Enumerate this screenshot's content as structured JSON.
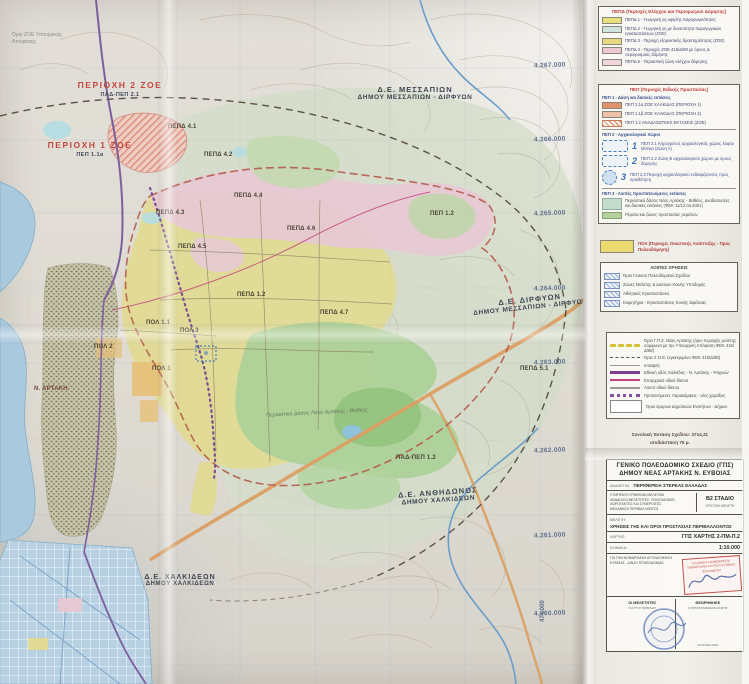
{
  "colors": {
    "zone_yellow": "#e0da94",
    "zone_pink": "#e7c9d5",
    "forest_green": "#abd098",
    "sea_blue": "#a9c9de",
    "road_orange": "#dc9e62",
    "boundary_red": "#b45b4b",
    "legend_title_red": "#c03a36",
    "stamp_red": "#c4524a",
    "stamp_blue": "#3a56a0"
  },
  "corner_note": {
    "line1": "Όριο ΖΟΕ Υπουργικής",
    "line2": "Απόφασης"
  },
  "map": {
    "region_labels": {
      "messapion": {
        "l1": "Δ.Ε. ΜΕΣΣΑΠΙΩΝ",
        "l2": "ΔΗΜΟΥ ΜΕΣΣΑΠΙΩΝ - ΔΙΡΦΥΩΝ"
      },
      "dirfyon": {
        "l1": "Δ.Ε. ΔΙΡΦΥΩΝ",
        "l2": "ΔΗΜΟΥ ΜΕΣΣΑΠΙΩΝ - ΔΙΡΦΥΩΝ"
      },
      "anthidonos": {
        "l1": "Δ.Ε. ΑΝΘΗΔΩΝΟΣ",
        "l2": "ΔΗΜΟΥ ΧΑΛΚΙΔΕΩΝ"
      },
      "chalkideon": {
        "l1": "Δ.Ε. ΧΑΛΚΙΔΕΩΝ",
        "l2": "ΔΗΜΟΥ ΧΑΛΚΙΔΕΩΝ"
      }
    },
    "red_labels": {
      "r1": "ΠΕΡΙΟΧΗ 2 ΖΟΕ",
      "r1sub": "ΠΑΔ-ΠΕΠ 2.1",
      "r2": "ΠΕΡΙΟΧΗ 1 ΖΟΕ",
      "r2sub": "ΠΕΠ 1.1α"
    },
    "zone_labels": [
      "ΠΕΠΔ 4.1",
      "ΠΕΠΔ 4.2",
      "ΠΕΠΔ 4.3",
      "ΠΕΠΔ 4.4",
      "ΠΕΠΔ 4.5",
      "ΠΕΠΔ 1.2",
      "ΠΕΠΔ 4.6",
      "ΠΕΠ 1.2",
      "ΠΟΛ 1.1",
      "ΠΟΛ 2",
      "ΠΟΛ 1",
      "ΠΟΛ 3",
      "Ν. ΑΡΤΑΚΗ",
      "ΠΑΔ-ΠΕΠ 1.2",
      "ΠΕΠΔ 4.7",
      "ΠΕΠΔ 5.1"
    ],
    "forest_label": "Περιαστικό Δάσος Νέας Αρτάκης - Βαθέος",
    "grid_labels": [
      "4.267.000",
      "4.266.000",
      "4.265.000",
      "4.264.000",
      "4.263.000",
      "4.262.000",
      "4.261.000",
      "4.260.000"
    ],
    "easting_label": "474.000"
  },
  "legend": {
    "pepd_panel": {
      "title": "ΠΕΠΔ (Περιοχές Ελέγχου και Περιορισμού Δόμησης)",
      "items": [
        {
          "label": "ΠΕΠΔ 1 - Γεωργική γη υψηλής παραγωγικότητας"
        },
        {
          "label": "ΠΕΠΔ 2 - Γεωργική γη με δυνατότητα παραγωγικών εγκαταστάσεων (ΖΟΕ)"
        },
        {
          "label": "ΠΕΠΔ 3 - Περιοχή εξορυκτικής δραστηριότητας (ΖΟΕ)"
        },
        {
          "label": "ΠΕΠΔ 4 - Περιοχές ΖΟΕ 416/Δ/88 με όρους & περιορισμούς δόμησης"
        },
        {
          "label": "ΠΕΠΔ 5 - Περιαστική ζώνη ελέγχου δόμησης"
        }
      ]
    },
    "pep_panel": {
      "title": "ΠΕΠ (Περιοχές Ειδικής Προστασίας)",
      "sub1": "ΠΕΠ 1 - Δάση και δασικές εκτάσεις",
      "items1": [
        {
          "label": "ΠΕΠ 1.1α ΖΟΕ ΧΑΛΚΙΔΑΣ (ΠΕΡΙΟΧΗ 1)"
        },
        {
          "label": "ΠΕΠ 1.1β ΖΟΕ ΧΑΛΚΙΔΑΣ (ΠΕΡΙΟΧΗ 2)"
        },
        {
          "label": "ΠΕΠ 1.2 ΑΝΑΔΑΣΩΤΕΕΣ ΕΚΤΑΣΕΙΣ (ΖΟΕ)"
        }
      ],
      "sub2": "ΠΕΠ 2 - Αρχαιολογικοί Χώροι",
      "items2": [
        {
          "num": "1",
          "label": "ΠΕΠ 2.1 Κηρυγμένος αρχαιολογικός χώρος λόφου Μύτικα (Ζώνη Α)"
        },
        {
          "num": "2",
          "label": "ΠΕΠ 2.2 Ζώνη Β αρχαιολογικού χώρου με όρους δόμησης"
        },
        {
          "num": "3",
          "label": "ΠΕΠ 2.3 Περιοχή αρχαιολογικού ενδιαφέροντος προς οριοθέτηση"
        }
      ],
      "sub3": "ΠΕΠ 3 - Λοιπές προστατευόμενες εκτάσεις",
      "items3": [
        {
          "label": "Περιαστικό δάσος Νέας Αρτάκης - Βαθέος, αναδασωτέες και δασικές εκτάσεις (ΦΕΚ 11/12.04.2001)"
        },
        {
          "label": "Ρέματα και ζώνες προστασίας ρεμάτων"
        }
      ]
    },
    "pol_row": {
      "label": "ΠΟΛ (Περιοχές Οικιστικής Ανάπτυξης - Προς Πολεοδόμηση)"
    },
    "other_panel": {
      "title": "ΛΟΙΠΕΣ ΧΡΗΣΕΙΣ",
      "items": [
        {
          "label": "Όρια Γενικού Πολεοδομικού Σχεδίου"
        },
        {
          "label": "Ζώνες Μελέτης & Δικτύων Κοινής Υποδομής"
        },
        {
          "label": "Αθλητικές Εγκαταστάσεις"
        },
        {
          "label": "Κοιμητήρια - Εγκαταστάσεις Κοινής Ωφέλειας"
        }
      ]
    },
    "lines_panel": {
      "items": [
        {
          "label": "Όριο Γ.Π.Σ. Νέας Αρτάκης (όριο περιοχής μελέτης σύμφωνα με την Υπουργική Απόφαση ΦΕΚ 416/Δ/88)"
        },
        {
          "label": "Όριο Ζ.Ο.Ε. (εγκεκριμένο ΦΕΚ 416/Δ/88)"
        },
        {
          "label": "Ισοϋψείς"
        },
        {
          "label": "Εθνική οδός Χαλκίδας - Ν. Αρτάκης - Ψαχνών"
        },
        {
          "label": "Επαρχιακό οδικό δίκτυο"
        },
        {
          "label": "Λοιπό οδικό δίκτυο"
        },
        {
          "label": "Προτεινόμενες παρακάμψεις - νέες χαράξεις"
        },
        {
          "label": "Όρια όμορων Δημοτικών Ενοτήτων - Δήμων"
        }
      ],
      "footer1": "Συνολική Έκταση Σχεδίου:  3714,31",
      "footer2": "ισοδιάσταση 75 μ."
    }
  },
  "titleblock": {
    "title1": "ΓΕΝΙΚΟ ΠΟΛΕΟΔΟΜΙΚΟ ΣΧΕΔΙΟ (ΓΠΣ)",
    "title2": "ΔΗΜΟΥ ΝΕΑΣ ΑΡΤΑΚΗΣ Ν. ΕΥΒΟΙΑΣ",
    "client_label": "ΑΝΑΘΕΤΗΣ:",
    "client": "ΠΕΡΙΦΕΡΕΙΑ ΣΤΕΡΕΑΣ ΕΛΛΑΔΑΣ",
    "consultant_lines": [
      "ΣΥΜΠΡΑΞΗ ΓΡΑΦΕΙΩΝ ΜΕΛΕΤΩΝ",
      "ΑΝΑΔΟΧΟΙ ΜΕΛΕΤΗΤΕΣ: ΠΟΛΕΟΔΟΜΟΙ,",
      "ΧΩΡΟΤΑΚΤΕΣ ΚΑΙ ΣΥΝΕΡΓΑΤΕΣ",
      "ΜΗΧΑΝΙΚΟΙ ΠΕΡΙΒΑΛΛΟΝΤΟΣ"
    ],
    "stage": "Β2 ΣΤΑΔΙΟ",
    "stage_sub": "ΟΡΙΣΤΙΚΗ ΜΕΛΕΤΗ",
    "study_label": "ΜΕΛΕΤΗ:",
    "study": "ΧΡΗΣΕΙΣ ΓΗΣ ΚΑΙ ΟΡΟΙ ΠΡΟΣΤΑΣΙΑΣ ΠΕΡΙΒΑΛΛΟΝΤΟΣ",
    "map_label": "ΧΑΡΤΗΣ:",
    "map_code": "ΓΠΣ ΧΑΡΤΗΣ 2-ΠΜ-Π.2",
    "scale_label": "ΚΛΙΜΑΚΑ:",
    "scale": "1:10.000",
    "approval_lines": [
      "ΓΙΑ ΤΗΝ ΝΟΜΑΡΧΙΑΚΗ ΑΥΤΟΔΙΟΙΚΗΣΗ",
      "ΕΥΒΟΙΑΣ - Δ/ΝΣΗ ΠΟΛΕΟΔΟΜΙΑΣ"
    ],
    "stamp_lines": [
      "ΕΛΛΗΝΙΚΗ ΔΗΜΟΚΡΑΤΙΑ",
      "ΝΟΜΑΡΧΙΑΚΗ ΑΥΤ/ΣΗ ΕΥΒΟΙΑΣ",
      "ΕΓΚΡΙΝΕΤΑΙ"
    ],
    "sig_left_title": "ΟΙ ΜΕΛΕΤΗΤΕΣ",
    "sig_left_sub": "ΓΙΑ ΤΗ ΣΥΜΠΡΑΞΗ",
    "sig_right_title": "ΘΕΩΡΗΘΗΚΕ",
    "sig_right_sub": "Ο ΠΡΟΪΣΤΑΜΕΝΟΣ Δ/ΝΣΗΣ",
    "sig_right_date": "ΧΑΛΚΙΔΑ 2010"
  }
}
